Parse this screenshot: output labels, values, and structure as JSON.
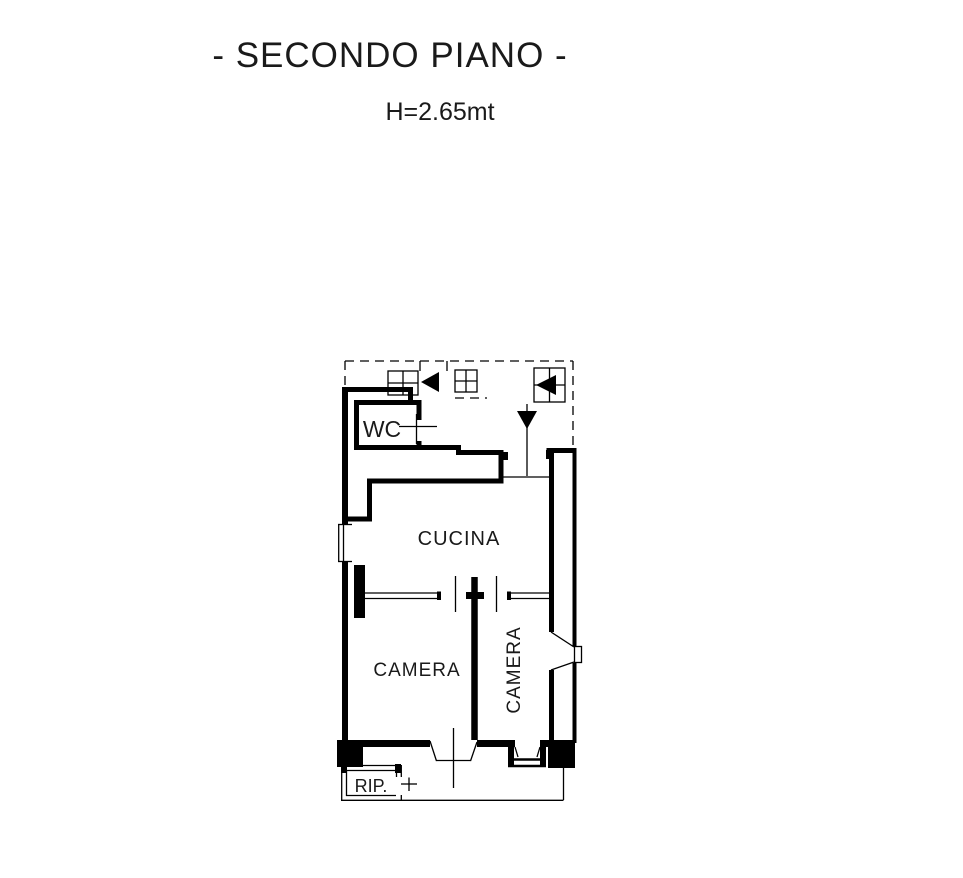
{
  "page": {
    "background": "#ffffff",
    "line_color": "#000000",
    "text_color": "#1a1a1a"
  },
  "header": {
    "title": "- SECONDO PIANO -",
    "height_note": "H=2.65mt"
  },
  "floor_plan": {
    "rooms": [
      {
        "id": "wc",
        "label": "WC"
      },
      {
        "id": "cucina",
        "label": "CUCINA"
      },
      {
        "id": "camera-left",
        "label": "CAMERA"
      },
      {
        "id": "camera-right",
        "label": "CAMERA",
        "orientation": "vertical"
      },
      {
        "id": "ripostiglio",
        "label": "RIP."
      }
    ],
    "icons": [
      "stair-arrow-left-icon",
      "stair-arrow-left-icon",
      "entry-direction-down-icon"
    ]
  }
}
